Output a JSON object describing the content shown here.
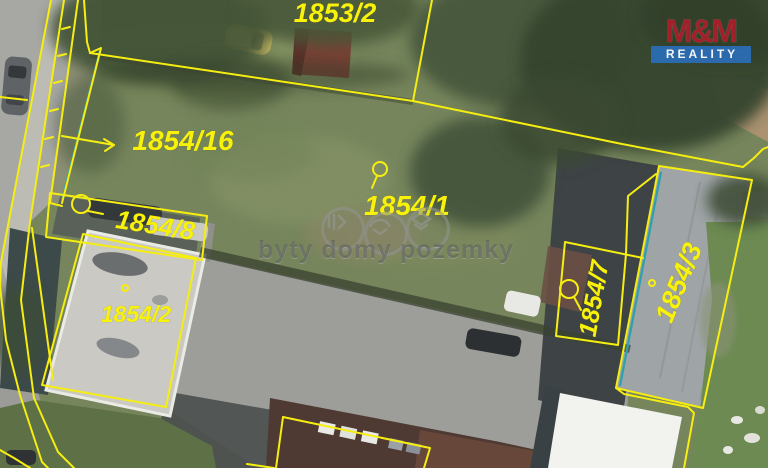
{
  "map": {
    "colors": {
      "boundary": "#f6ee11",
      "utility_line": "#2e9fb0",
      "label": "#f8f20a"
    },
    "labels": {
      "p1853_2": "1853/2",
      "p1854_16": "1854/16",
      "p1854_1": "1854/1",
      "p1854_8": "1854/8",
      "p1854_2": "1854/2",
      "p1854_7": "1854/7",
      "p1854_3": "1854/3"
    }
  },
  "watermark": {
    "text": "byty domy pozemky",
    "icons": [
      "apartments-icon",
      "car-icon",
      "land-icon"
    ]
  },
  "logo": {
    "name": "M&M",
    "subtitle": "REALITY",
    "name_color": "#a91f2a",
    "bar_color": "#2a6db4"
  }
}
